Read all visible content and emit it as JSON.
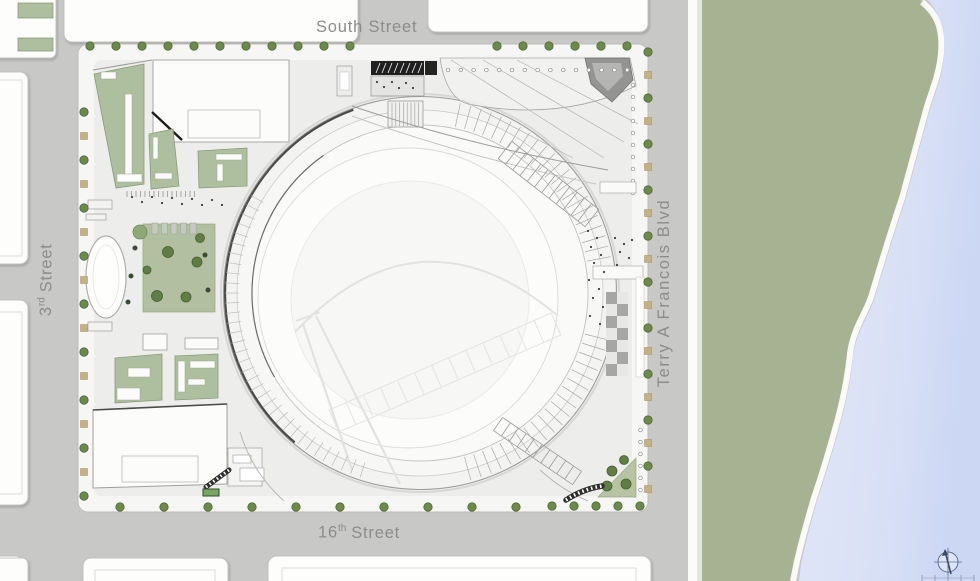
{
  "streets": {
    "south_street": "South Street",
    "third_street": {
      "number": "3",
      "ordinal": "rd",
      "suffix": "Street"
    },
    "sixteenth_street": {
      "number": "16",
      "ordinal": "th",
      "suffix": "Street"
    },
    "terry_blvd": "Terry A Francois Blvd"
  },
  "colors": {
    "street": "#c8c8c7",
    "site": "#ededec",
    "site_sidewalk": "#f6f6f5",
    "building_white": "#fdfdfc",
    "green_roof": "#aebfa0",
    "lawn_green": "#b3bfa1",
    "park_green": "#a7b292",
    "tree_green": "#6c8a4b",
    "water_blue": "#dbe2f7",
    "label_gray": "#8c8c8c"
  },
  "icons": {
    "compass": "north-arrow-compass",
    "tree": "street-tree",
    "shrub": "planting-bed"
  }
}
